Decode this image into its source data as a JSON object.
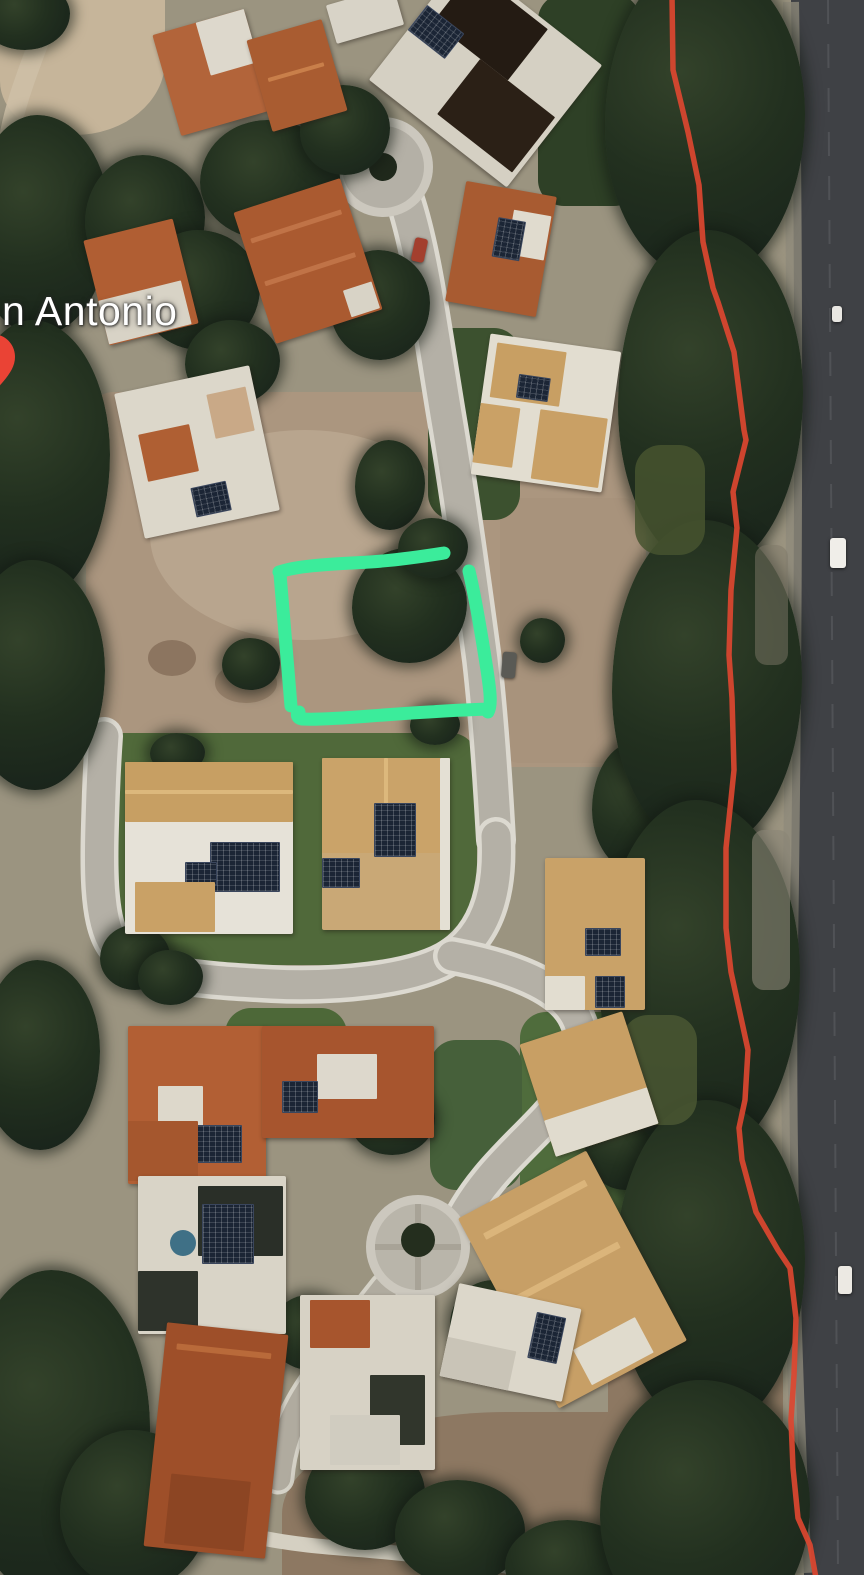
{
  "map": {
    "view_type": "satellite",
    "place_label": "n Antonio",
    "annotations": {
      "lot_outline_color": "#3BEC9B",
      "route_line_color": "#DC4630",
      "pin_color": "#EA4335"
    }
  }
}
